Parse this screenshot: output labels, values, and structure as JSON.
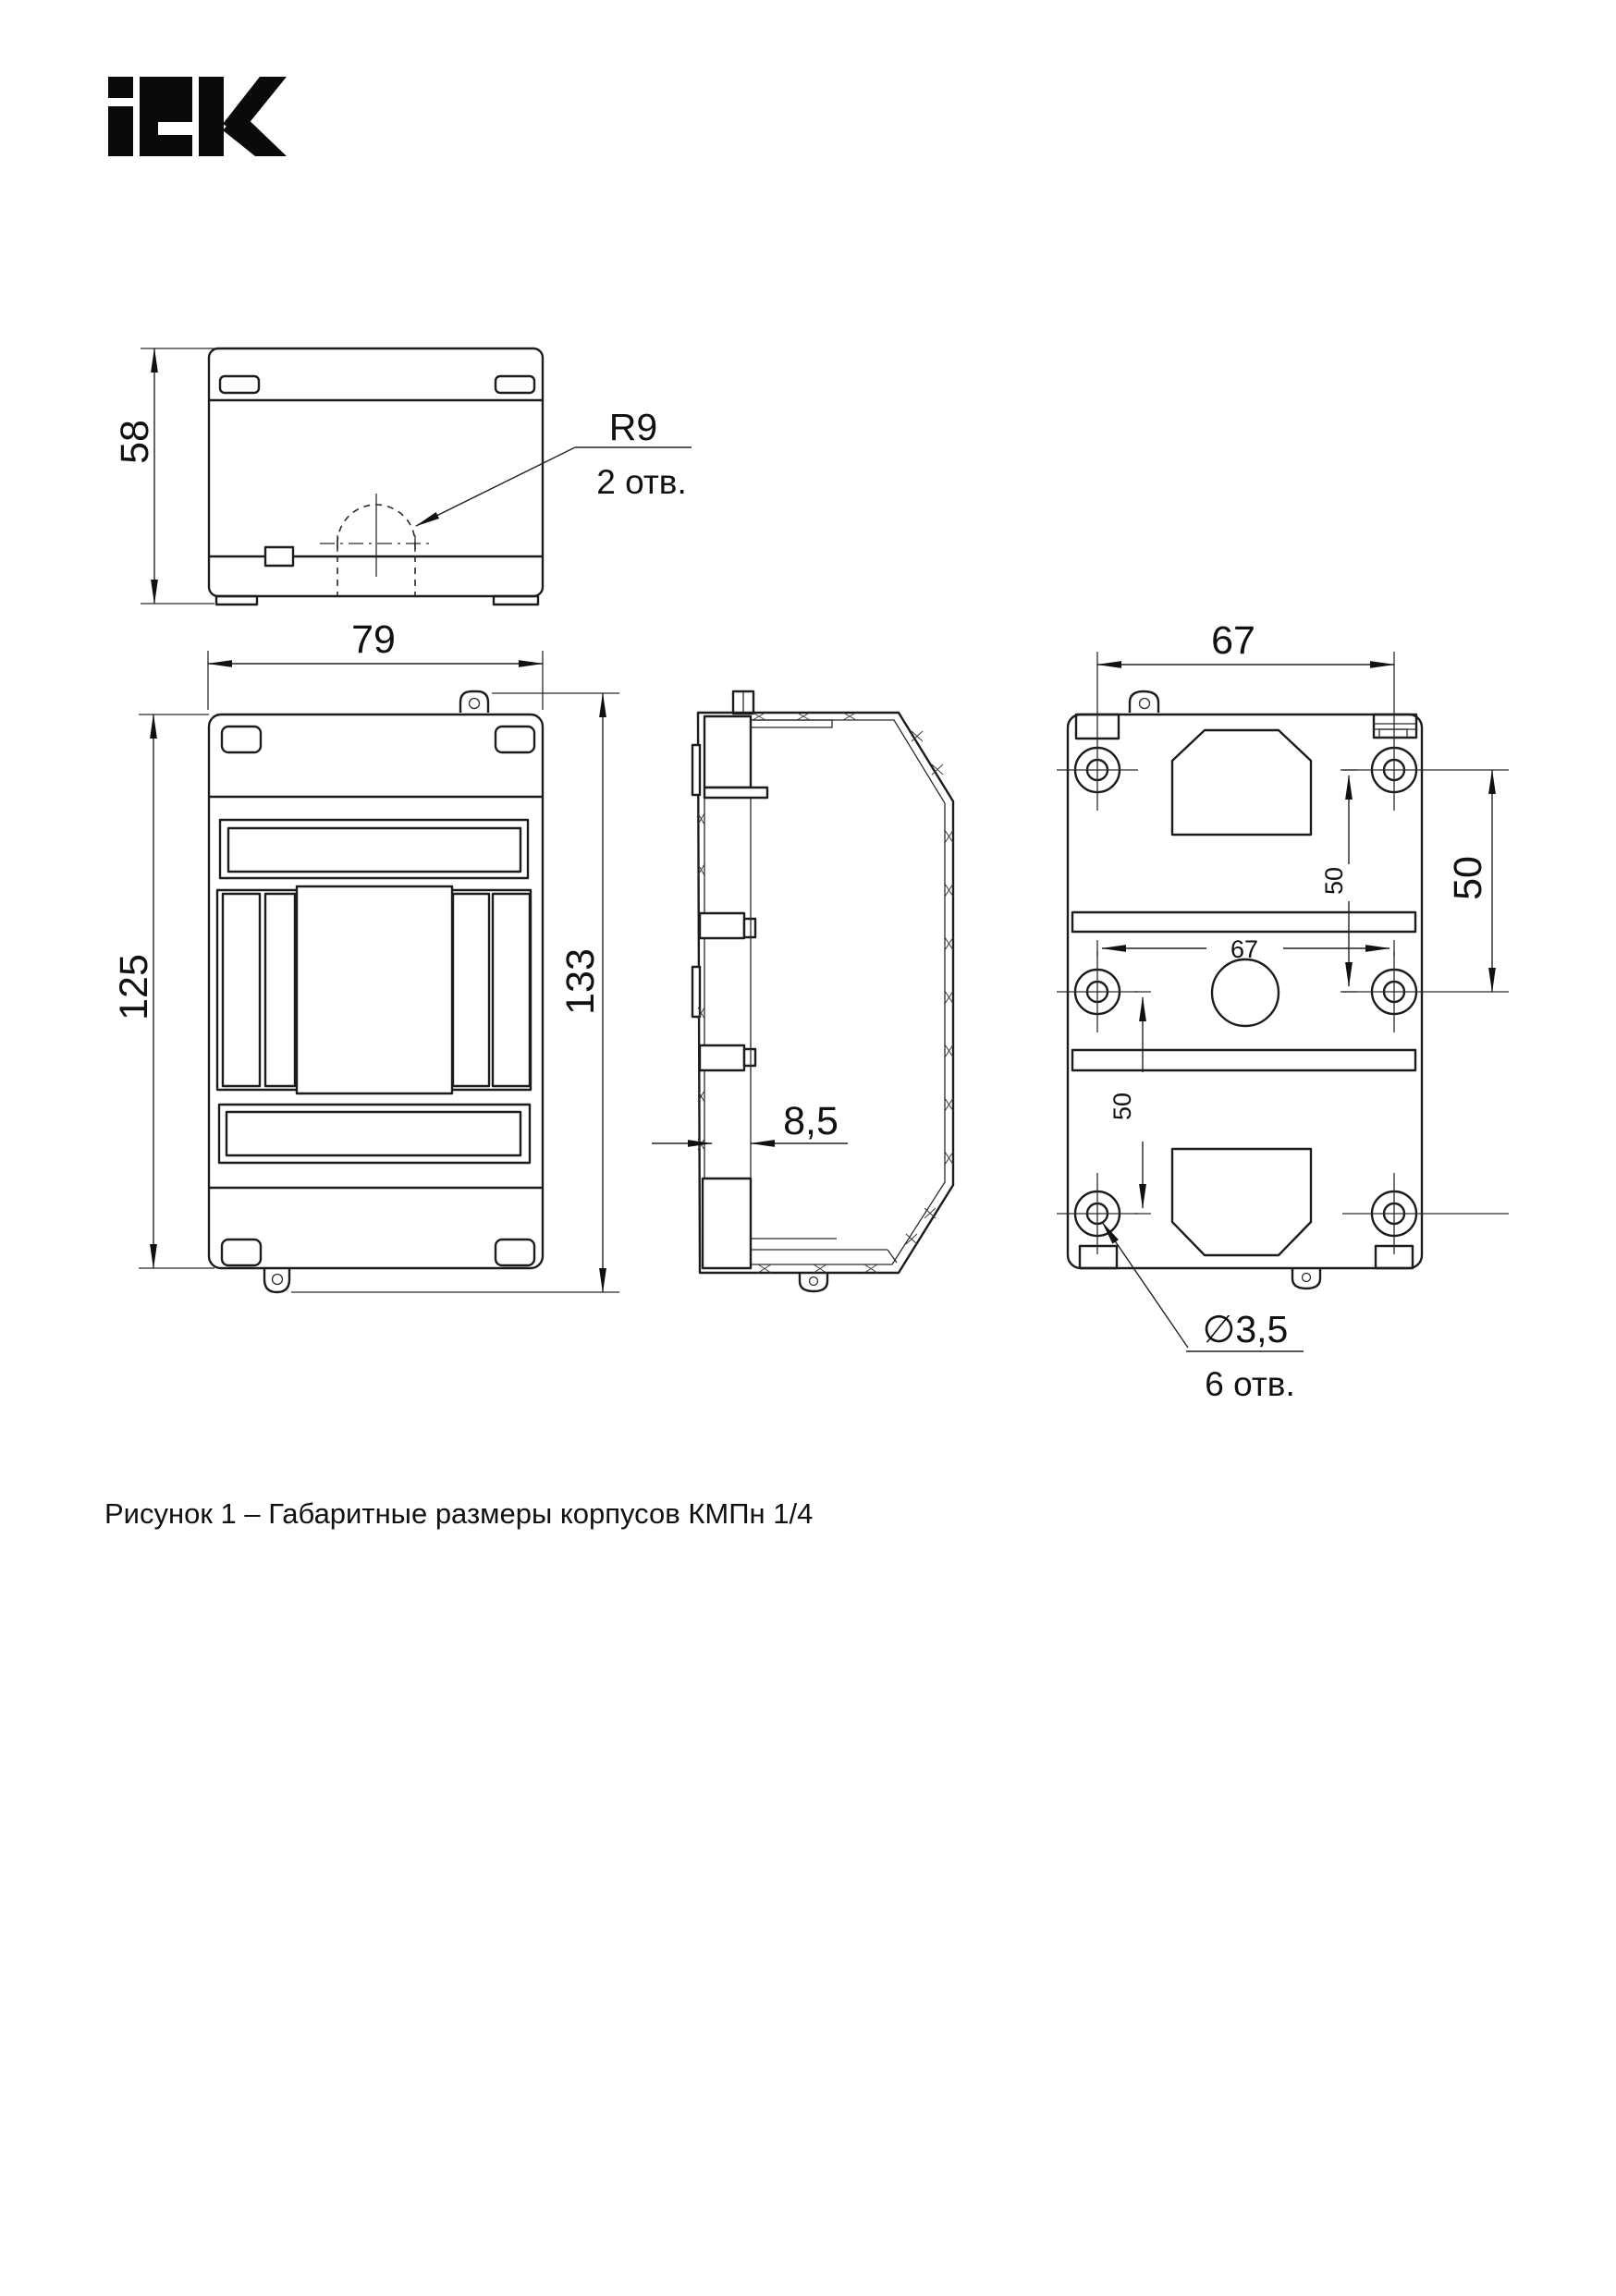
{
  "logo": {
    "brand": "IEK"
  },
  "caption": "Рисунок 1 – Габаритные размеры корпусов КМПн 1/4",
  "colors": {
    "line": "#1c1c1c",
    "background": "#ffffff"
  },
  "dimensions": {
    "top_view": {
      "height": "58",
      "knockout_radius": "R9",
      "knockout_count": "2 отв."
    },
    "front_view": {
      "width": "79",
      "body_height": "125",
      "total_height": "133"
    },
    "side_view": {
      "wall_depth": "8,5"
    },
    "back_view": {
      "hole_span_top": "67",
      "hole_span_inner": "67",
      "hole_pitch_right": "50",
      "hole_pitch_inner_top": "50",
      "hole_pitch_inner_bottom": "50",
      "hole_diameter": "∅3,5",
      "hole_count": "6 отв."
    }
  }
}
